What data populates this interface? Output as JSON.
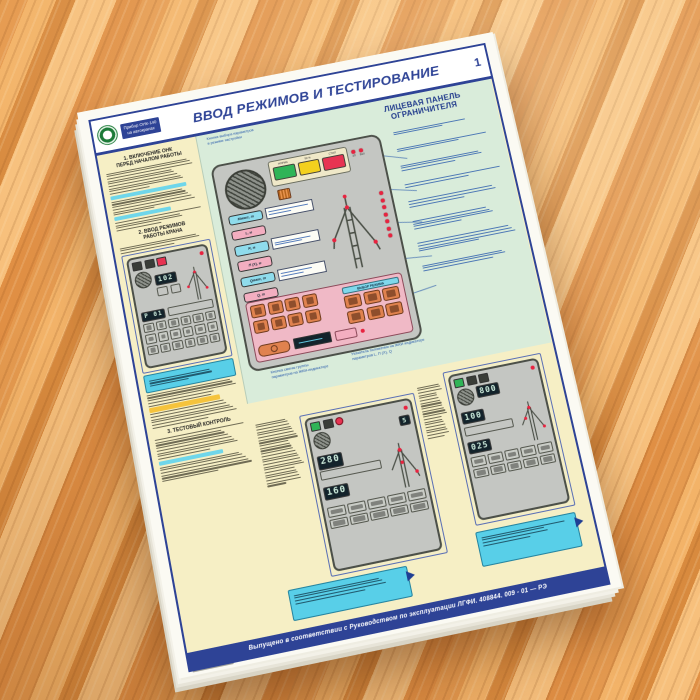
{
  "poster": {
    "page_number": "1",
    "brand": "Прибор ОНК-140\nна автокранах",
    "title": "ВВОД РЕЖИМОВ И ТЕСТИРОВАНИЕ",
    "panel_heading": "ЛИЦЕВАЯ ПАНЕЛЬ\nОГРАНИЧИТЕЛЯ",
    "sections": [
      "1. ВКЛЮЧЕНИЕ ОНК\nПЕРЕД НАЧАЛОМ РАБОТЫ",
      "2. ВВОД РЕЖИМОВ\nРАБОТЫ КРАНА",
      "3. ТЕСТОВЫЙ КОНТРОЛЬ"
    ],
    "panel": {
      "indicator_labels": [
        "НОРМА",
        "90 %",
        "СТОП"
      ],
      "side_led_labels": [
        "ЗП",
        "ВКЛ"
      ],
      "tags": [
        "Mмакс, т",
        "L, м",
        "R, м",
        "П (X), м",
        "Qмакс, т",
        "Q, т"
      ],
      "mode_group_label": "ВЫБОР РЕЖИМА",
      "callout_top": "Кнопки выбора параметров\nв режиме настройки",
      "callout_bottom_left": "Кнопка смены группы\nпараметров на ЖКИ-индикаторе",
      "callout_bottom_right": "Указатель положения на ЖКИ-индикаторе параметров L, П (X), Q"
    },
    "cards": [
      {
        "displays": [
          "102",
          "P 01"
        ]
      },
      {
        "displays": [
          "5",
          "280",
          "160"
        ]
      },
      {
        "displays": [
          "800",
          "100",
          "025"
        ]
      }
    ],
    "footer": "Выпущено в соответствии с Руководством по эксплуатации ЛГФИ. 408844. 009 - 01 — РЭ",
    "colors": {
      "frame_blue": "#2e4396",
      "green_panel_bg": "#d9ecda",
      "sheet_yellow": "#f6efc5",
      "note_cyan": "#58cfe8",
      "panel_gray": "#c4c6c2",
      "button_orange": "#e0824e",
      "lamp_green": "#2fb457",
      "lamp_yellow": "#f3d01e",
      "lamp_red": "#e73352",
      "wood_orange": "#e89a4e"
    }
  }
}
